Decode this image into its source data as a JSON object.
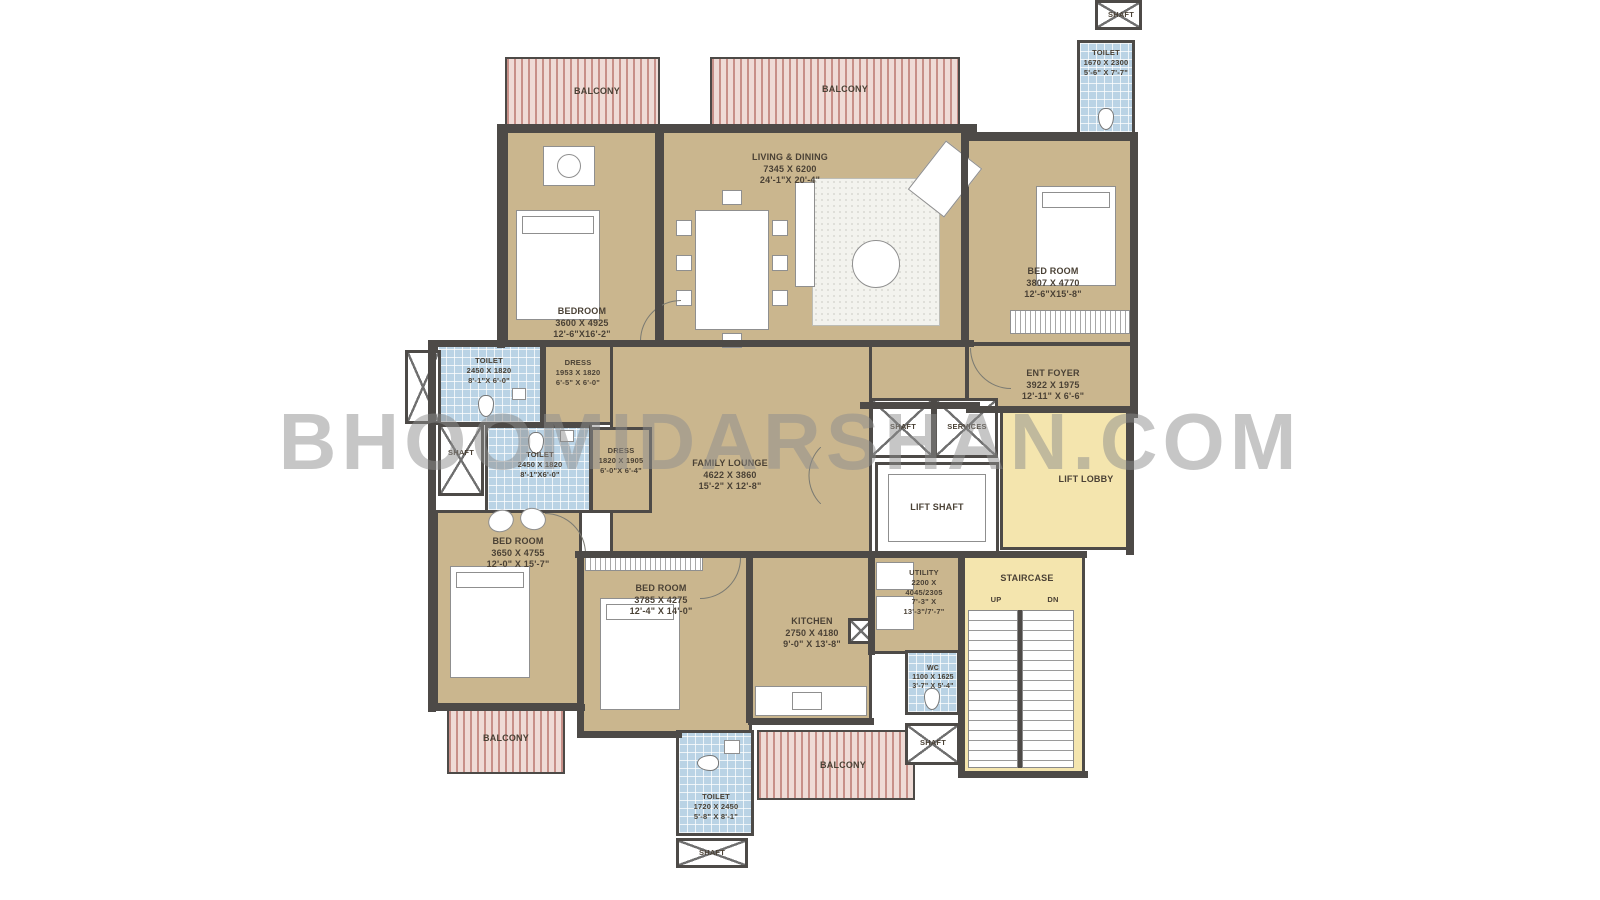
{
  "watermark": "BHOOMIDARSHAN.COM",
  "colors": {
    "floor": "#cab68e",
    "wall": "#4d4a47",
    "wet_area": "#bad3e5",
    "balcony_stripe": "#ba766e",
    "lobby_yellow": "#f4e5ae",
    "label_text": "#4a4135",
    "watermark_gray": "#8e8e8e"
  },
  "rooms": {
    "living_dining": {
      "name": "LIVING & DINING",
      "mm": "7345 X 6200",
      "ft": "24'-1\"X 20'-4\""
    },
    "bedroom_tl": {
      "name": "BEDROOM",
      "mm": "3600 X 4925",
      "ft": "12'-6\"X16'-2\""
    },
    "bedroom_tr": {
      "name": "BED ROOM",
      "mm": "3807 X 4770",
      "ft": "12'-6\"X15'-8\""
    },
    "bedroom_bl": {
      "name": "BED ROOM",
      "mm": "3650 X 4755",
      "ft": "12'-0\" X 15'-7\""
    },
    "bedroom_bm": {
      "name": "BED ROOM",
      "mm": "3785 X 4275",
      "ft": "12'-4\" X 14'-0\""
    },
    "kitchen": {
      "name": "KITCHEN",
      "mm": "2750 X 4180",
      "ft": "9'-0\" X 13'-8\""
    },
    "family_lounge": {
      "name": "FAMILY LOUNGE",
      "mm": "4622 X 3860",
      "ft": "15'-2\" X 12'-8\""
    },
    "ent_foyer": {
      "name": "ENT FOYER",
      "mm": "3922 X 1975",
      "ft": "12'-11\" X 6'-6\""
    },
    "toilet_tr": {
      "name": "TOILET",
      "mm": "1670 X 2300",
      "ft": "5'-6\" X 7'-7\""
    },
    "toilet_l1": {
      "name": "TOILET",
      "mm": "2450 X 1820",
      "ft": "8'-1\"X 6'-0\""
    },
    "toilet_l2": {
      "name": "TOILET",
      "mm": "2450 X 1820",
      "ft": "8'-1\"X6'-0\""
    },
    "toilet_b": {
      "name": "TOILET",
      "mm": "1720 X 2450",
      "ft": "5'-8\" X 8'-1\""
    },
    "dress_1": {
      "name": "DRESS",
      "mm": "1953 X 1820",
      "ft": "6'-5\" X 6'-0\""
    },
    "dress_2": {
      "name": "DRESS",
      "mm": "1820 X 1905",
      "ft": "6'-0\"X 6'-4\""
    },
    "wc": {
      "name": "WC",
      "mm": "1100 X 1625",
      "ft": "3'-7\" X 5'-4\""
    },
    "utility": {
      "name": "UTILITY",
      "l2": "2200 X",
      "l3": "4045/2305",
      "l4": "7'-3\" X",
      "l5": "13'-3\"/7'-7\""
    },
    "staircase": {
      "name": "STAIRCASE",
      "up": "UP",
      "dn": "DN"
    },
    "lift_shaft": {
      "name": "LIFT SHAFT"
    },
    "lift_lobby": {
      "name": "LIFT LOBBY"
    },
    "services": {
      "name": "SERVICES"
    },
    "shaft": {
      "name": "SHAFT"
    },
    "balcony": {
      "name": "BALCONY"
    }
  }
}
